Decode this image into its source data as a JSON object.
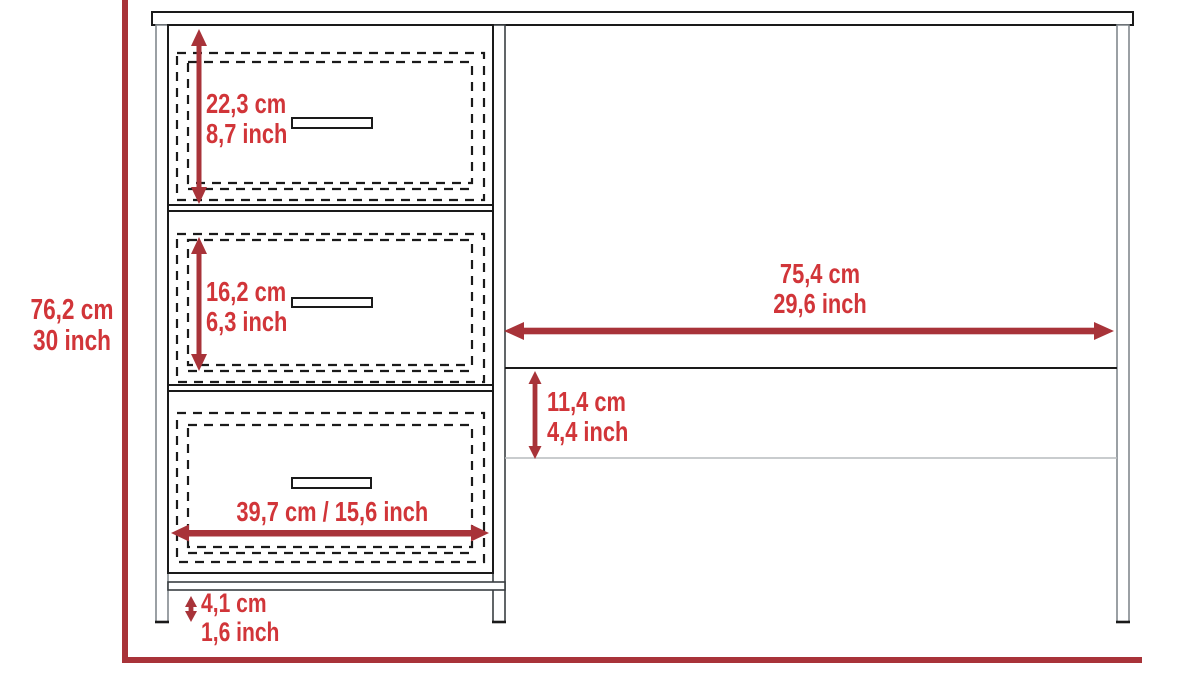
{
  "colors": {
    "dimension_text": "#d13539",
    "dimension_line": "#a83339",
    "outline": "#1a1a1a",
    "leg_gray": "#82898d",
    "shelf_light": "#b7bcbe",
    "background": "#ffffff"
  },
  "diagram": {
    "total_height": {
      "cm": "76,2 cm",
      "inch": "30 inch"
    },
    "top_drawer_height": {
      "cm": "22,3 cm",
      "inch": "8,7 inch"
    },
    "middle_drawer_height": {
      "cm": "16,2 cm",
      "inch": "6,3 inch"
    },
    "drawer_width": {
      "text": "39,7 cm / 15,6 inch"
    },
    "worktop_clear_width": {
      "cm": "75,4 cm",
      "inch": "29,6 inch"
    },
    "knee_clearance_height": {
      "cm": "11,4 cm",
      "inch": "4,4 inch"
    },
    "bottom_rail_gap": {
      "cm": "4,1 cm",
      "inch": "1,6 inch"
    }
  }
}
